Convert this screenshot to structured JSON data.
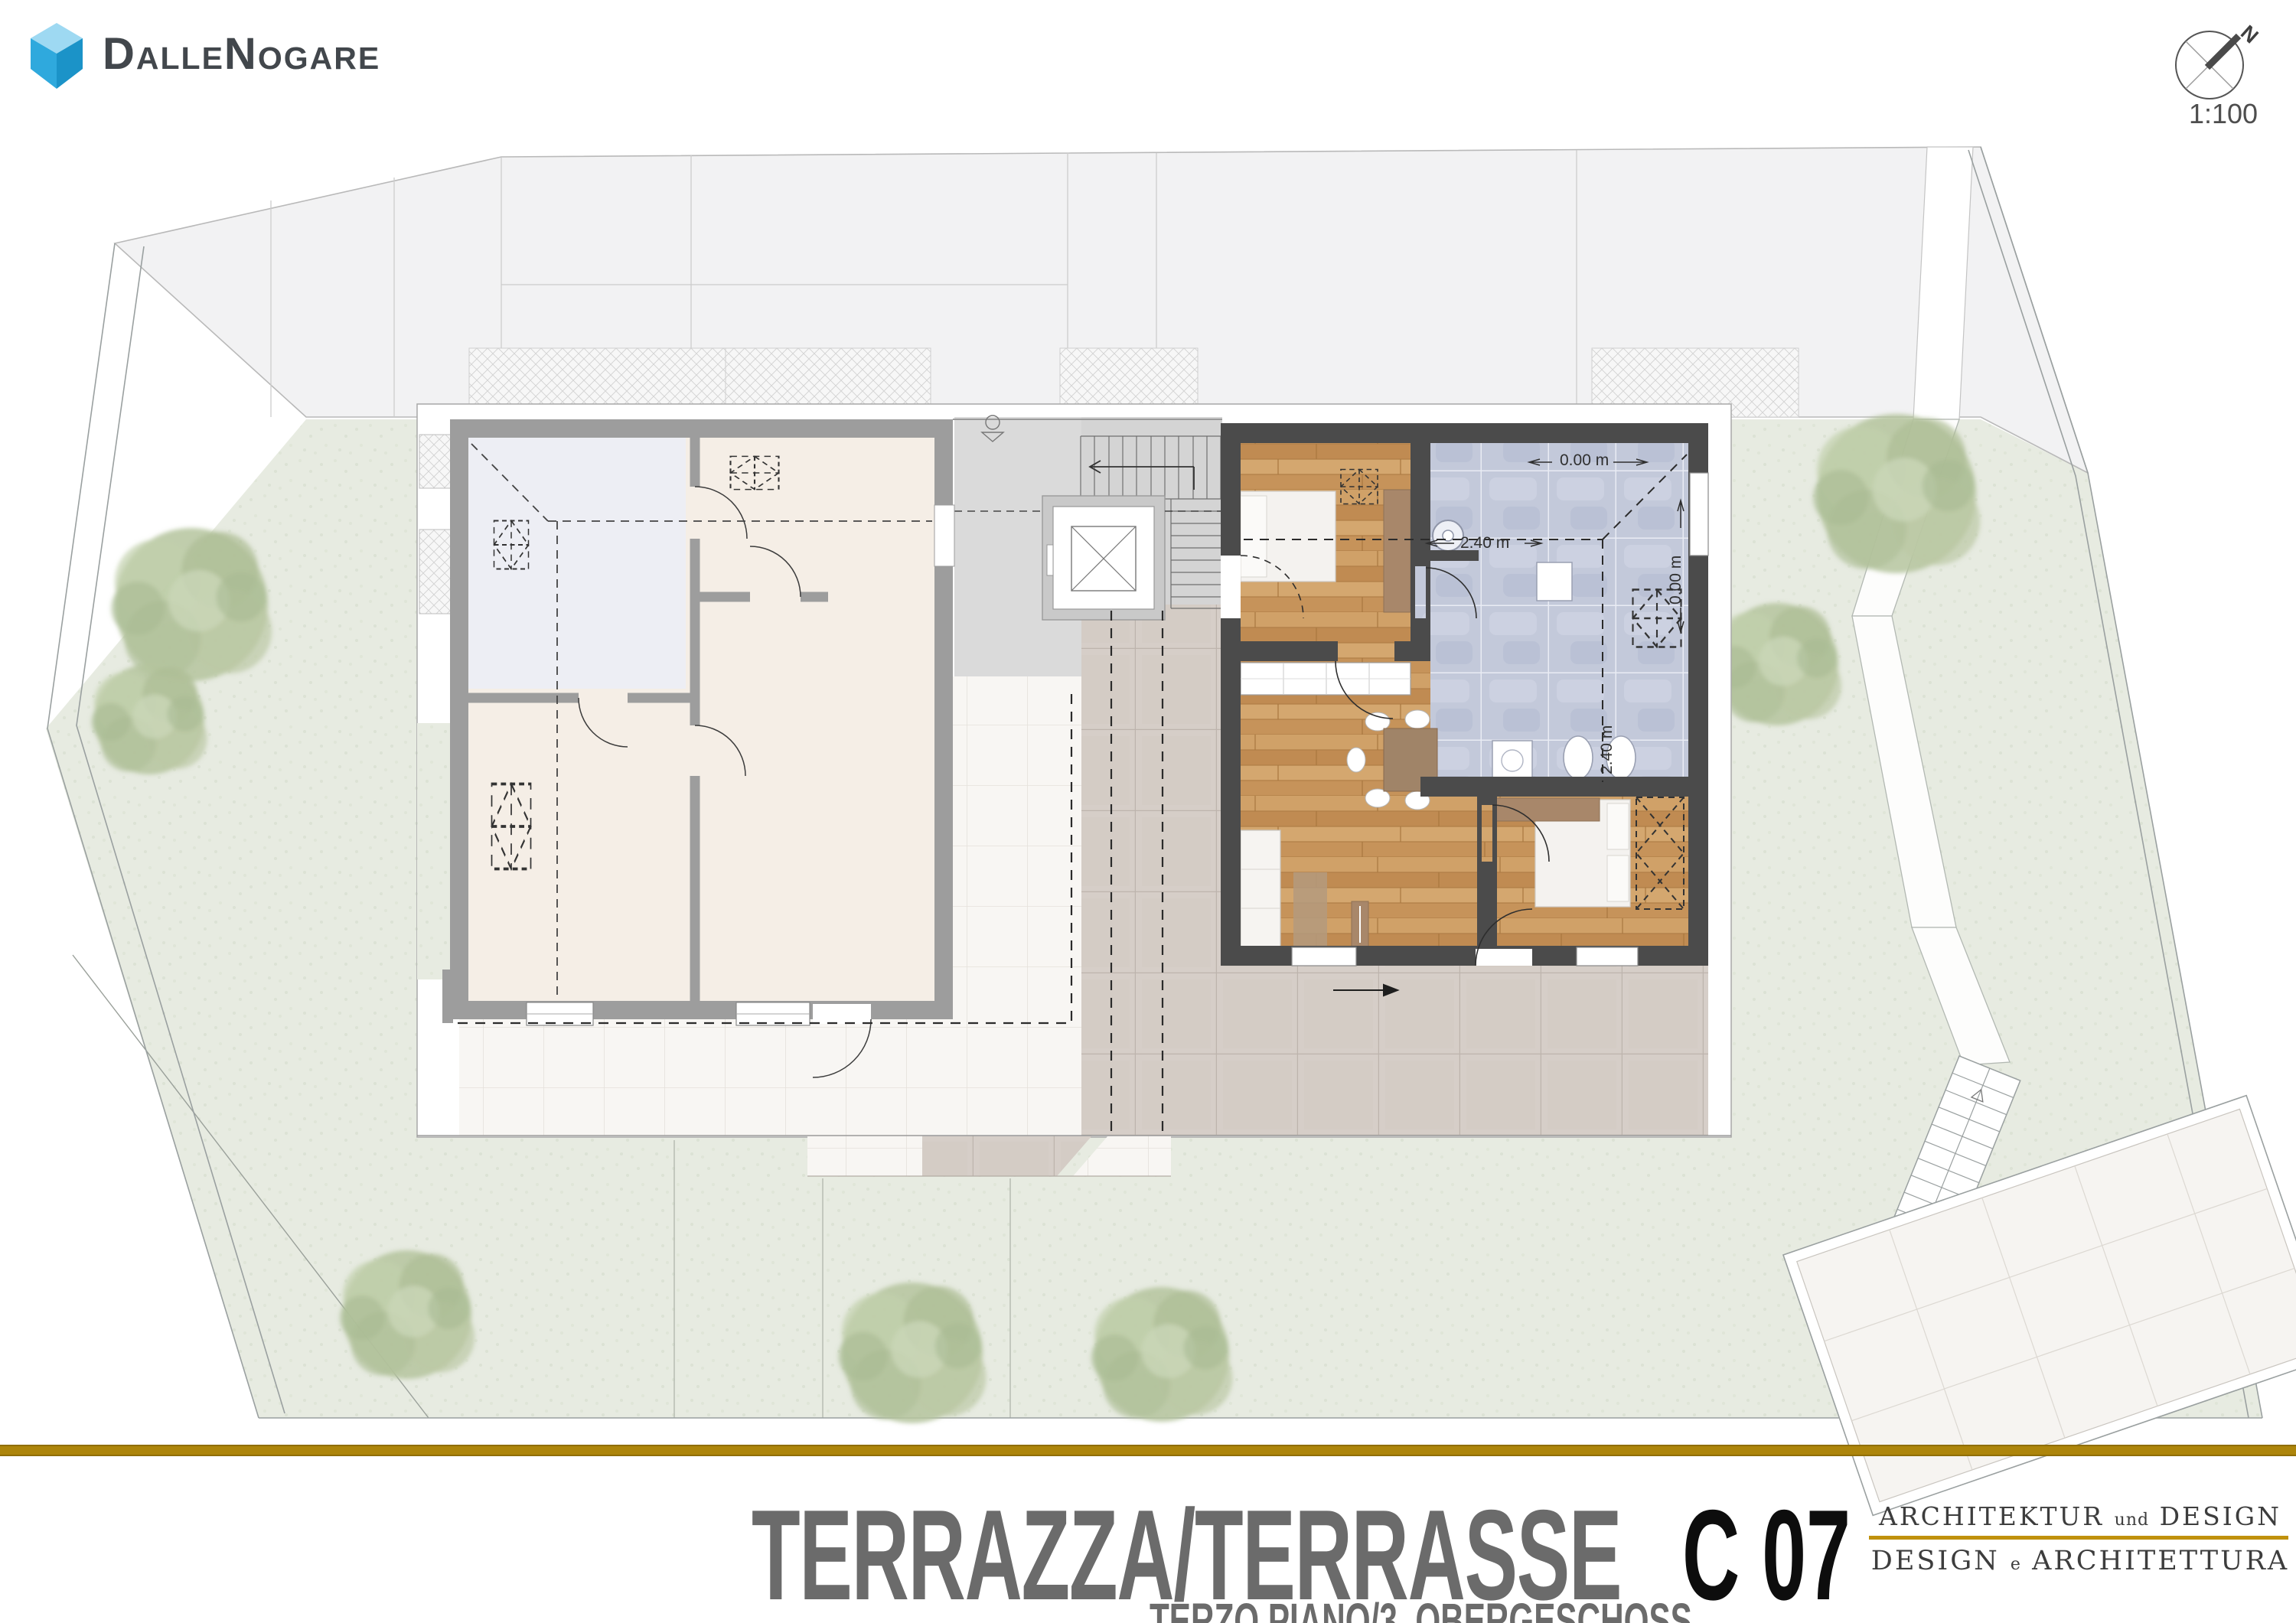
{
  "brand": {
    "wordmark": "DalleNogare"
  },
  "compass": {
    "north_label": "N",
    "scale_label": "1:100"
  },
  "title_block": {
    "title": "TERRAZZA/TERRASSE",
    "unit_code": "C 07",
    "subtitle": "TERZO PIANO/3. OBERGESCHOSS"
  },
  "architect": {
    "line1_a": "ARCHITEKTUR",
    "line1_b": "und",
    "line1_c": "DESIGN",
    "line2_a": "DESIGN",
    "line2_b": "e",
    "line2_c": "ARCHITETTURA"
  },
  "plan": {
    "annotations": {
      "level_zero_top": "0.00 m",
      "level_zero_side": "0.00 m",
      "height_240_mid": "2.40 m",
      "height_240_vert": "2.40 m"
    }
  },
  "colors": {
    "gold_bar": "#ad850b",
    "gold_rule": "#c0910c",
    "wall_dark": "#4b4b4b",
    "wall_light": "#9d9d9d",
    "wood_floor": "#c9995f",
    "bath_tile": "#c3c9da",
    "lawn": "#e7ebe1",
    "tile_taupe": "#d6cec8",
    "tile_white": "#f8f6f3",
    "room_blue": "#edeef4",
    "room_beige": "#f5eee6",
    "brand_blue_top": "#9ed9f2",
    "brand_blue_left": "#2fa9dd",
    "brand_blue_right": "#1b93c8"
  }
}
